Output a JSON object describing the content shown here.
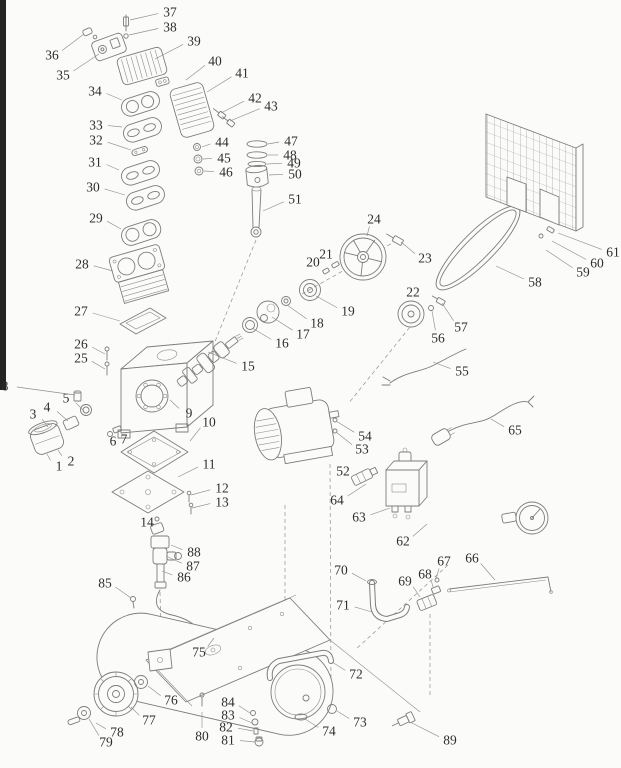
{
  "diagram": {
    "kind": "exploded-parts-diagram",
    "subject": "belt-drive air compressor",
    "background": "#fbfbf9",
    "line_color": "#7d7d7d",
    "label_color": "#2e2e2e"
  },
  "parts": [
    {
      "num": "1",
      "x": 59,
      "y": 466,
      "tx": 47,
      "ty": 454
    },
    {
      "num": "2",
      "x": 71,
      "y": 461,
      "tx": 58,
      "ty": 450
    },
    {
      "num": "3",
      "x": 33,
      "y": 414,
      "tx": 48,
      "ty": 427
    },
    {
      "num": "4",
      "x": 47,
      "y": 407,
      "tx": 68,
      "ty": 421
    },
    {
      "num": "5",
      "x": 66,
      "y": 398,
      "tx": 84,
      "ty": 411
    },
    {
      "num": "6",
      "x": 113,
      "y": 441,
      "tx": 110,
      "ty": 434
    },
    {
      "num": "7",
      "x": 124,
      "y": 439,
      "tx": 117,
      "ty": 430
    },
    {
      "num": "8",
      "x": 5,
      "y": 386,
      "tx": 75,
      "ty": 395
    },
    {
      "num": "9",
      "x": 189,
      "y": 413,
      "tx": 170,
      "ty": 400
    },
    {
      "num": "10",
      "x": 209,
      "y": 422,
      "tx": 190,
      "ty": 441
    },
    {
      "num": "11",
      "x": 209,
      "y": 464,
      "tx": 178,
      "ty": 477
    },
    {
      "num": "12",
      "x": 222,
      "y": 488,
      "tx": 191,
      "ty": 495
    },
    {
      "num": "13",
      "x": 222,
      "y": 502,
      "tx": 192,
      "ty": 508
    },
    {
      "num": "14",
      "x": 147,
      "y": 522,
      "tx": 156,
      "ty": 528
    },
    {
      "num": "15",
      "x": 248,
      "y": 366,
      "tx": 208,
      "ty": 352
    },
    {
      "num": "16",
      "x": 282,
      "y": 343,
      "tx": 252,
      "ty": 328
    },
    {
      "num": "17",
      "x": 303,
      "y": 334,
      "tx": 272,
      "ty": 317
    },
    {
      "num": "18",
      "x": 317,
      "y": 323,
      "tx": 287,
      "ty": 305
    },
    {
      "num": "19",
      "x": 348,
      "y": 311,
      "tx": 316,
      "ty": 296
    },
    {
      "num": "20",
      "x": 313,
      "y": 262,
      "tx": 325,
      "ty": 270
    },
    {
      "num": "21",
      "x": 326,
      "y": 254,
      "tx": 334,
      "ty": 263
    },
    {
      "num": "22",
      "x": 413,
      "y": 292,
      "tx": 412,
      "ty": 304
    },
    {
      "num": "23",
      "x": 425,
      "y": 258,
      "tx": 401,
      "ty": 242
    },
    {
      "num": "24",
      "x": 374,
      "y": 219,
      "tx": 367,
      "ty": 236
    },
    {
      "num": "25",
      "x": 81,
      "y": 358,
      "tx": 105,
      "ty": 369
    },
    {
      "num": "26",
      "x": 81,
      "y": 344,
      "tx": 105,
      "ty": 354
    },
    {
      "num": "27",
      "x": 81,
      "y": 311,
      "tx": 120,
      "ty": 321
    },
    {
      "num": "28",
      "x": 82,
      "y": 264,
      "tx": 113,
      "ty": 271
    },
    {
      "num": "29",
      "x": 96,
      "y": 218,
      "tx": 121,
      "ty": 229
    },
    {
      "num": "30",
      "x": 93,
      "y": 187,
      "tx": 125,
      "ty": 195
    },
    {
      "num": "31",
      "x": 95,
      "y": 162,
      "tx": 119,
      "ty": 170
    },
    {
      "num": "32",
      "x": 96,
      "y": 140,
      "tx": 131,
      "ty": 150
    },
    {
      "num": "33",
      "x": 96,
      "y": 125,
      "tx": 122,
      "ty": 127
    },
    {
      "num": "34",
      "x": 95,
      "y": 91,
      "tx": 122,
      "ty": 100
    },
    {
      "num": "35",
      "x": 63,
      "y": 75,
      "tx": 99,
      "ty": 54
    },
    {
      "num": "36",
      "x": 52,
      "y": 55,
      "tx": 84,
      "ty": 34
    },
    {
      "num": "37",
      "x": 170,
      "y": 12,
      "tx": 130,
      "ty": 20
    },
    {
      "num": "38",
      "x": 170,
      "y": 27,
      "tx": 129,
      "ty": 35
    },
    {
      "num": "39",
      "x": 194,
      "y": 41,
      "tx": 155,
      "ty": 59
    },
    {
      "num": "40",
      "x": 215,
      "y": 61,
      "tx": 186,
      "ty": 80
    },
    {
      "num": "41",
      "x": 242,
      "y": 73,
      "tx": 207,
      "ty": 92
    },
    {
      "num": "42",
      "x": 255,
      "y": 98,
      "tx": 221,
      "ty": 113
    },
    {
      "num": "43",
      "x": 271,
      "y": 106,
      "tx": 230,
      "ty": 121
    },
    {
      "num": "44",
      "x": 222,
      "y": 142,
      "tx": 202,
      "ty": 147
    },
    {
      "num": "45",
      "x": 224,
      "y": 158,
      "tx": 203,
      "ty": 159
    },
    {
      "num": "46",
      "x": 226,
      "y": 172,
      "tx": 204,
      "ty": 171
    },
    {
      "num": "47",
      "x": 291,
      "y": 141,
      "tx": 268,
      "ty": 144
    },
    {
      "num": "48",
      "x": 290,
      "y": 155,
      "tx": 268,
      "ty": 155
    },
    {
      "num": "49",
      "x": 294,
      "y": 163,
      "tx": 267,
      "ty": 164
    },
    {
      "num": "50",
      "x": 295,
      "y": 174,
      "tx": 269,
      "ty": 175
    },
    {
      "num": "51",
      "x": 295,
      "y": 199,
      "tx": 263,
      "ty": 211
    },
    {
      "num": "52",
      "x": 343,
      "y": 471,
      "tx": 356,
      "ty": 477
    },
    {
      "num": "53",
      "x": 362,
      "y": 449,
      "tx": 336,
      "ty": 432
    },
    {
      "num": "54",
      "x": 365,
      "y": 436,
      "tx": 336,
      "ty": 421
    },
    {
      "num": "55",
      "x": 462,
      "y": 371,
      "tx": 433,
      "ty": 362
    },
    {
      "num": "56",
      "x": 438,
      "y": 338,
      "tx": 432,
      "ty": 311
    },
    {
      "num": "57",
      "x": 461,
      "y": 327,
      "tx": 442,
      "ty": 303
    },
    {
      "num": "58",
      "x": 535,
      "y": 282,
      "tx": 496,
      "ty": 266
    },
    {
      "num": "59",
      "x": 583,
      "y": 272,
      "tx": 546,
      "ty": 250
    },
    {
      "num": "60",
      "x": 597,
      "y": 263,
      "tx": 552,
      "ty": 241
    },
    {
      "num": "61",
      "x": 613,
      "y": 252,
      "tx": 558,
      "ty": 233
    },
    {
      "num": "62",
      "x": 403,
      "y": 541,
      "tx": 427,
      "ty": 524
    },
    {
      "num": "63",
      "x": 359,
      "y": 517,
      "tx": 390,
      "ty": 508
    },
    {
      "num": "64",
      "x": 337,
      "y": 500,
      "tx": 366,
      "ty": 484
    },
    {
      "num": "65",
      "x": 515,
      "y": 430,
      "tx": 491,
      "ty": 419
    },
    {
      "num": "66",
      "x": 472,
      "y": 558,
      "tx": 495,
      "ty": 580
    },
    {
      "num": "67",
      "x": 444,
      "y": 561,
      "tx": 436,
      "ty": 579
    },
    {
      "num": "68",
      "x": 425,
      "y": 574,
      "tx": 433,
      "ty": 587
    },
    {
      "num": "69",
      "x": 405,
      "y": 581,
      "tx": 420,
      "ty": 597
    },
    {
      "num": "70",
      "x": 341,
      "y": 570,
      "tx": 366,
      "ty": 581
    },
    {
      "num": "71",
      "x": 343,
      "y": 605,
      "tx": 372,
      "ty": 612
    },
    {
      "num": "72",
      "x": 356,
      "y": 674,
      "tx": 332,
      "ty": 662
    },
    {
      "num": "73",
      "x": 360,
      "y": 722,
      "tx": 337,
      "ty": 711
    },
    {
      "num": "74",
      "x": 329,
      "y": 731,
      "tx": 305,
      "ty": 719
    },
    {
      "num": "75",
      "x": 199,
      "y": 652,
      "tx": 214,
      "ty": 638
    },
    {
      "num": "76",
      "x": 171,
      "y": 700,
      "tx": 148,
      "ty": 686
    },
    {
      "num": "77",
      "x": 149,
      "y": 720,
      "tx": 131,
      "ty": 707
    },
    {
      "num": "78",
      "x": 117,
      "y": 732,
      "tx": 96,
      "ty": 723
    },
    {
      "num": "79",
      "x": 106,
      "y": 742,
      "tx": 89,
      "ty": 719
    },
    {
      "num": "80",
      "x": 202,
      "y": 736,
      "tx": 202,
      "ty": 712
    },
    {
      "num": "81",
      "x": 228,
      "y": 740,
      "tx": 255,
      "ty": 742
    },
    {
      "num": "82",
      "x": 226,
      "y": 727,
      "tx": 253,
      "ty": 731
    },
    {
      "num": "83",
      "x": 228,
      "y": 715,
      "tx": 252,
      "ty": 723
    },
    {
      "num": "84",
      "x": 228,
      "y": 702,
      "tx": 250,
      "ty": 713
    },
    {
      "num": "85",
      "x": 105,
      "y": 583,
      "tx": 131,
      "ty": 598
    },
    {
      "num": "86",
      "x": 184,
      "y": 577,
      "tx": 162,
      "ty": 571
    },
    {
      "num": "87",
      "x": 193,
      "y": 566,
      "tx": 166,
      "ty": 556
    },
    {
      "num": "88",
      "x": 194,
      "y": 552,
      "tx": 171,
      "ty": 545
    },
    {
      "num": "89",
      "x": 450,
      "y": 740,
      "tx": 412,
      "ty": 723
    }
  ]
}
